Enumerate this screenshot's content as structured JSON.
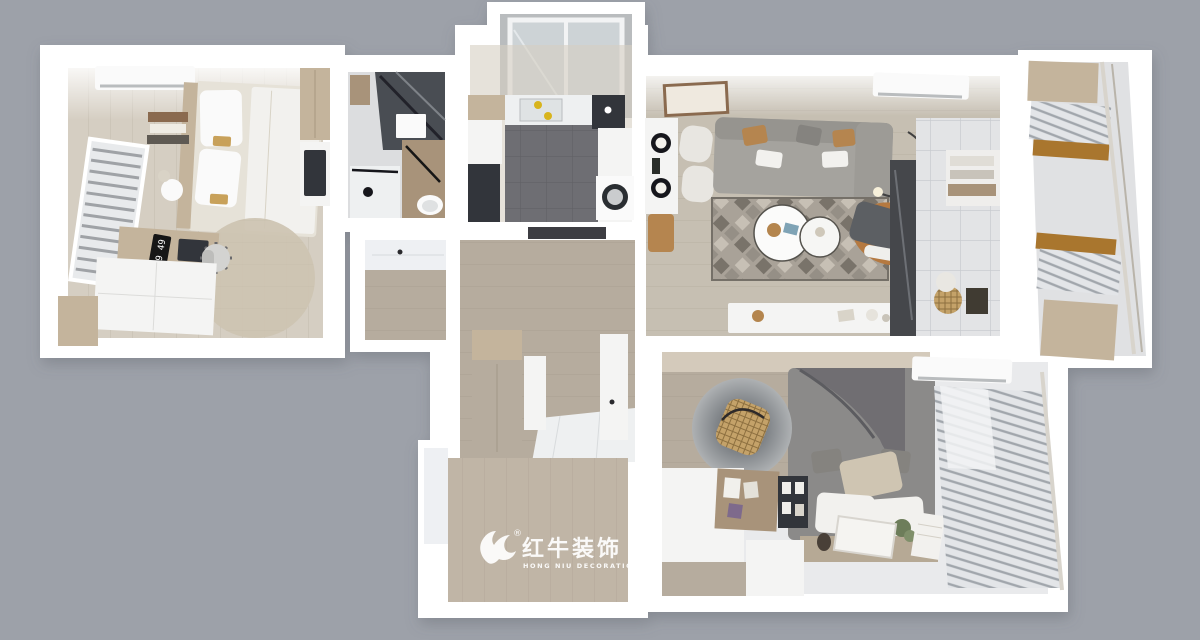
{
  "image": {
    "kind": "3d-floorplan-render",
    "description": "Top-down dollhouse render of a furnished small apartment on a gray backdrop"
  },
  "watermark": {
    "brand_cn": "红牛装饰",
    "brand_en": "HONG NIU DECORATION",
    "registered_mark": "®"
  },
  "bedroom_left": {
    "desk_clock_time": "9 49"
  },
  "rooms": [
    {
      "id": "bedroom-left",
      "contents": "bed, pillows, AC unit, radiator window, desk with flip clock, office chair, round rug, white wardrobe"
    },
    {
      "id": "bathroom",
      "contents": "glass shower, wood vanity, sink counter, toilet, water heater"
    },
    {
      "id": "kitchen",
      "contents": "dark tile floor, counters with sink, fridge, washing machine, service balcony"
    },
    {
      "id": "living-dining-room",
      "contents": "gray sofa, geometric rug, round coffee tables, cognac armchair, dining table with chairs, TV console, AC unit, arc lamp"
    },
    {
      "id": "entry-hall",
      "contents": "dark marble strip, open wardrobe with clothes, baskets"
    },
    {
      "id": "balcony-right",
      "contents": "glazed balcony, wood cabinets, blinds"
    },
    {
      "id": "hallway",
      "contents": "wood cabinets, white tile floor, paneled nook"
    },
    {
      "id": "bedroom-bottom",
      "contents": "gray canopy bed, hanging rattan chair on round rug, desk with pinboard, plant, books, AC unit, blinds window, watermark platform"
    }
  ],
  "colors": {
    "background": "#9da1a9",
    "walls": "#ffffff",
    "wood_floor": "#d5cec2",
    "dark_tile": "#6e6e73",
    "sofa_gray": "#a5a39e",
    "bed_gray": "#8b8a89",
    "accent_cognac": "#b5793f",
    "accent_tan": "#b5854f",
    "watermark_white": "#ffffff"
  }
}
